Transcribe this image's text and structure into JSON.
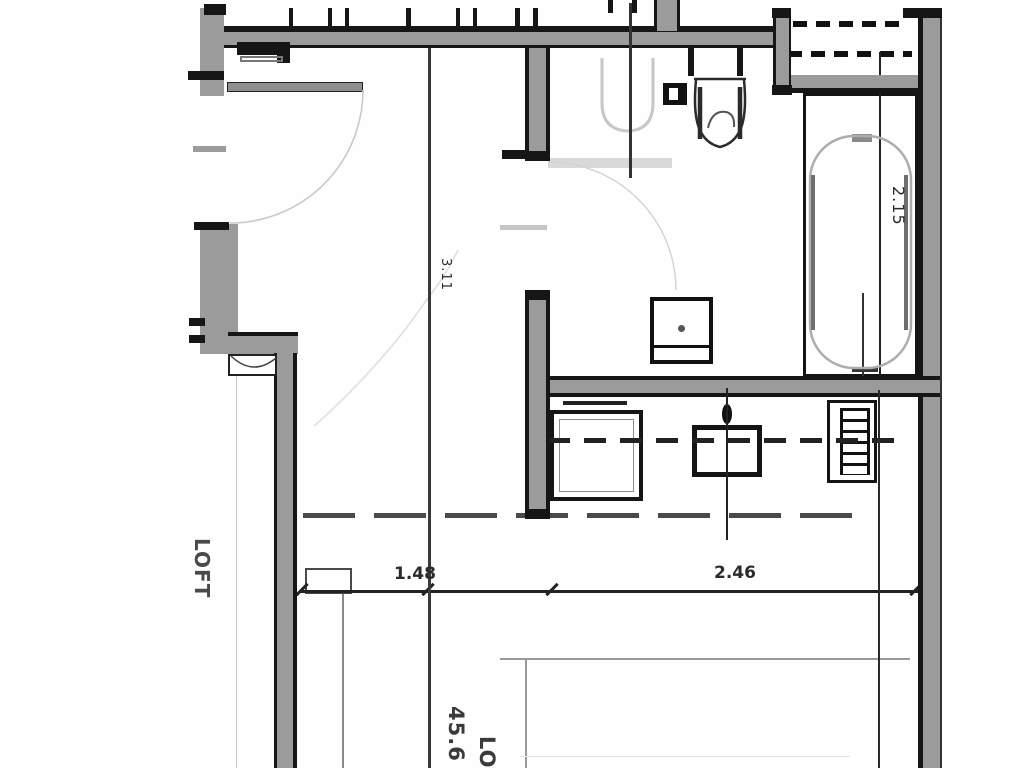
{
  "floorplan": {
    "dimensions": {
      "bathtub": "2.15",
      "hallway": "3.11",
      "bottom_left": "1.48",
      "bottom_right": "2.46"
    },
    "rooms": {
      "adjacent_label": "LOFT",
      "main_label": "LOFT",
      "main_area": "45.6"
    },
    "colors": {
      "bg": "#fefefe",
      "wall_fill": "#9b9b9b",
      "wall_edge": "#161616",
      "line_dark": "#2e2e2e",
      "line_light": "#9a9a9a",
      "ghost": "#c7c7c7",
      "text": "#2b2b2b"
    }
  }
}
